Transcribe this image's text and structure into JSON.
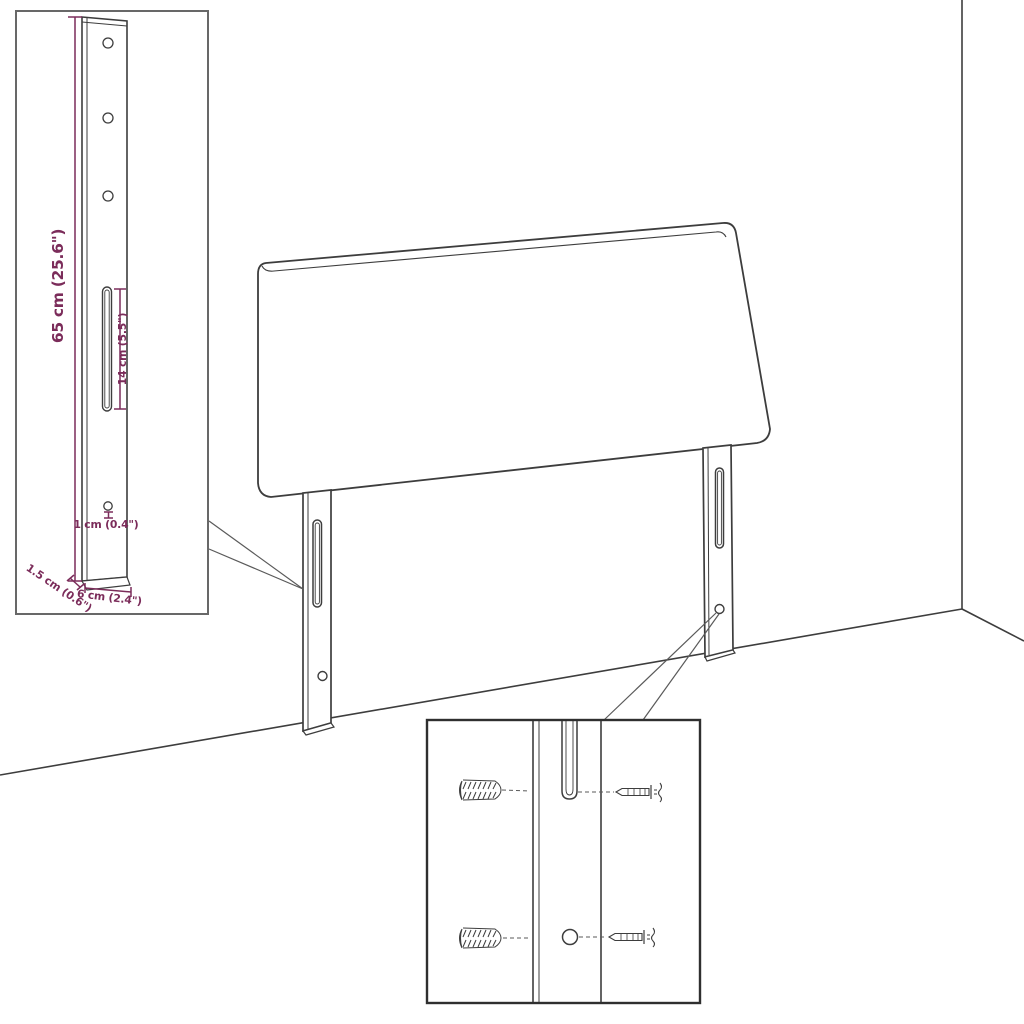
{
  "diagram": {
    "subject": "headboard-assembly-diagram",
    "dimension_labels": {
      "height": "65 cm (25.6\")",
      "slot": "14 cm (5.5\")",
      "hole": "1 cm (0.4\")",
      "thickness": "1.5 cm (0.6\")",
      "width": "6 cm (2.4\")"
    },
    "colors": {
      "line": "#3d3d3d",
      "line_light": "#5a5a5a",
      "dimension": "#7b2c5a",
      "inset_border": "#686868",
      "detail_border": "#2f2f2f",
      "background": "#ffffff"
    }
  }
}
